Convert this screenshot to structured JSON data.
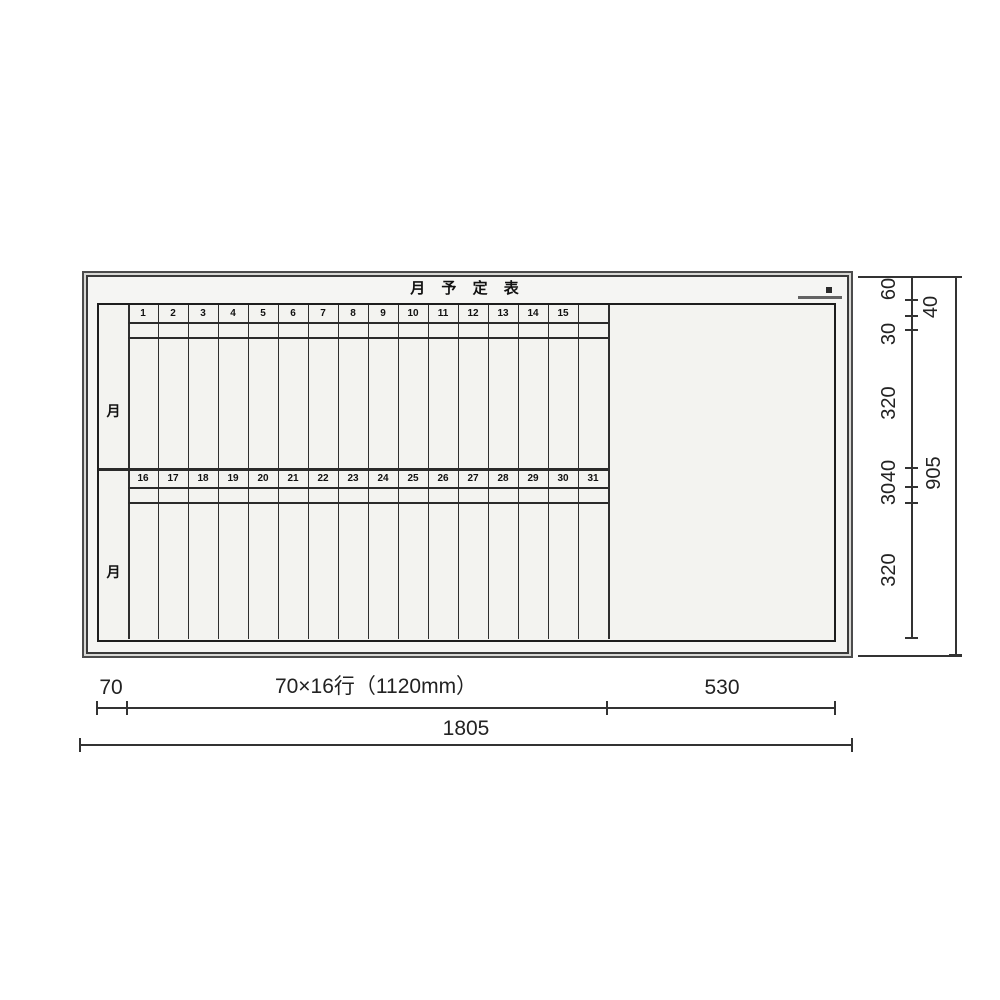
{
  "title": "月 予 定 表",
  "calendar": {
    "month_label_top": "月",
    "month_label_bottom": "月",
    "days_top": [
      "1",
      "2",
      "3",
      "4",
      "5",
      "6",
      "7",
      "8",
      "9",
      "10",
      "11",
      "12",
      "13",
      "14",
      "15",
      ""
    ],
    "days_bottom": [
      "16",
      "17",
      "18",
      "19",
      "20",
      "21",
      "22",
      "23",
      "24",
      "25",
      "26",
      "27",
      "28",
      "29",
      "30",
      "31"
    ]
  },
  "dimensions": {
    "right": [
      "60",
      "40",
      "30",
      "320",
      "40",
      "30",
      "320"
    ],
    "right_total": "905",
    "bottom": [
      "70",
      "70×16行（1120mm）",
      "530"
    ],
    "bottom_total": "1805"
  },
  "colors": {
    "frame": "#d8d8d5",
    "face": "#f5f5f3",
    "line": "#2a2a2a"
  }
}
